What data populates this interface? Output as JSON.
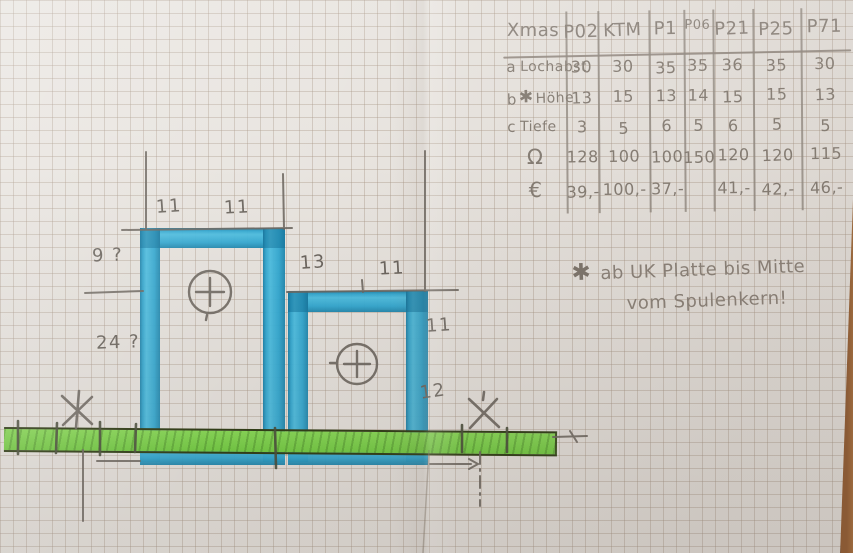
{
  "table": {
    "corner": "Xmas",
    "columns": [
      "P02",
      "KTM",
      "P1",
      "P06",
      "P21",
      "P25",
      "P71"
    ],
    "rows": [
      {
        "key": "a",
        "star": "",
        "label": "Lochabst",
        "values": [
          "30",
          "30",
          "35",
          "35",
          "36",
          "35",
          "30"
        ]
      },
      {
        "key": "b",
        "star": "✱",
        "label": "Höhe",
        "values": [
          "13",
          "15",
          "13",
          "14",
          "15",
          "15",
          "13"
        ]
      },
      {
        "key": "c",
        "star": "",
        "label": "Tiefe",
        "values": [
          "3",
          "5",
          "6",
          "5",
          "6",
          "5",
          "5"
        ]
      },
      {
        "key": "Ω",
        "star": "",
        "label": "",
        "values": [
          "128",
          "100",
          "100",
          "150",
          "120",
          "120",
          "115"
        ]
      },
      {
        "key": "€",
        "star": "",
        "label": "",
        "values": [
          "39,-",
          "100,-",
          "37,-",
          "",
          "41,-",
          "42,-",
          "46,-"
        ]
      }
    ]
  },
  "note": {
    "marker": "✱",
    "line1": "ab UK Platte bis Mitte",
    "line2": "vom Spulenkern!"
  },
  "dimensions": {
    "left_top_left": "11",
    "left_top_right": "11",
    "right_top_left": "13",
    "right_top_right": "11",
    "left_upper": "9 ?",
    "left_lower": "24 ?",
    "right_upper": "11",
    "right_lower": "12"
  },
  "colors": {
    "tape": "#2fa8d2",
    "plate": "#7cd348",
    "pencil": "#6b655e",
    "wood": "#8a5a35"
  }
}
